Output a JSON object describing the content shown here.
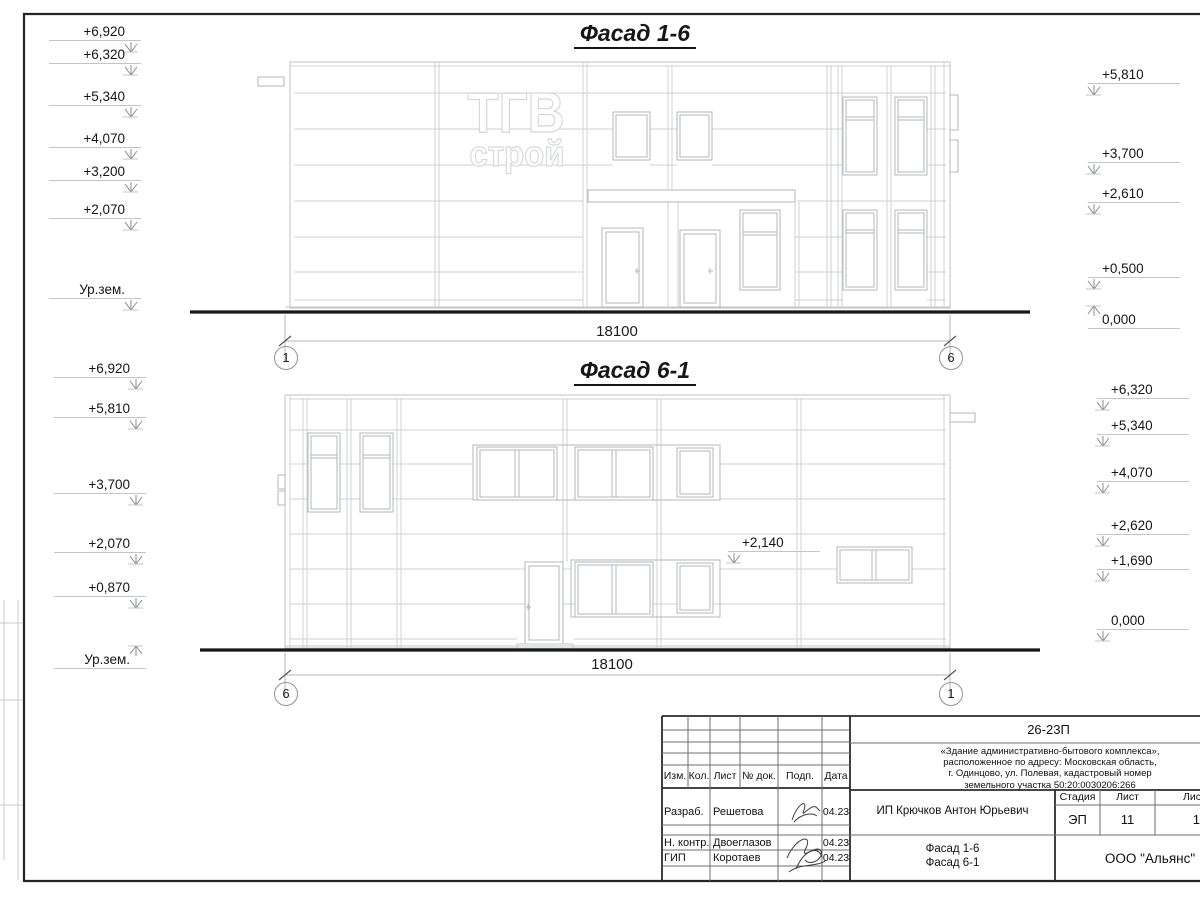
{
  "palette": {
    "line_light": "#d0d2d4",
    "line_mid": "#b5b8ba",
    "ground": "#181818",
    "frame": "#242424"
  },
  "logo": {
    "line1": "ТГВ",
    "line2": "строй"
  },
  "facade1": {
    "title": "Фасад 1-6",
    "dimension": "18100",
    "axis_left": "1",
    "axis_right": "6",
    "marks_left": [
      {
        "label": "+6,920",
        "x": 131,
        "y": 24,
        "dir": "down",
        "side": "left"
      },
      {
        "label": "+6,320",
        "x": 131,
        "y": 47,
        "dir": "down",
        "side": "left"
      },
      {
        "label": "+5,340",
        "x": 131,
        "y": 89,
        "dir": "down",
        "side": "left"
      },
      {
        "label": "+4,070",
        "x": 131,
        "y": 131,
        "dir": "down",
        "side": "left"
      },
      {
        "label": "+3,200",
        "x": 131,
        "y": 164,
        "dir": "down",
        "side": "left"
      },
      {
        "label": "+2,070",
        "x": 131,
        "y": 202,
        "dir": "down",
        "side": "left"
      },
      {
        "label": "Ур.зем.",
        "x": 131,
        "y": 282,
        "dir": "down",
        "side": "left"
      }
    ],
    "marks_right": [
      {
        "label": "+5,810",
        "x": 1094,
        "y": 67,
        "dir": "down",
        "side": "right"
      },
      {
        "label": "+3,700",
        "x": 1094,
        "y": 146,
        "dir": "down",
        "side": "right"
      },
      {
        "label": "+2,610",
        "x": 1094,
        "y": 186,
        "dir": "down",
        "side": "right"
      },
      {
        "label": "+0,500",
        "x": 1094,
        "y": 261,
        "dir": "down",
        "side": "right"
      },
      {
        "label": "0,000",
        "x": 1094,
        "y": 312,
        "dir": "up",
        "side": "right"
      }
    ]
  },
  "facade2": {
    "title": "Фасад 6-1",
    "dimension": "18100",
    "axis_left": "6",
    "axis_right": "1",
    "annotation": {
      "label": "+2,140",
      "x": 734,
      "y": 535,
      "dir": "down",
      "side": "right"
    },
    "marks_left": [
      {
        "label": "+6,920",
        "x": 136,
        "y": 361,
        "dir": "down",
        "side": "left"
      },
      {
        "label": "+5,810",
        "x": 136,
        "y": 401,
        "dir": "down",
        "side": "left"
      },
      {
        "label": "+3,700",
        "x": 136,
        "y": 477,
        "dir": "down",
        "side": "left"
      },
      {
        "label": "+2,070",
        "x": 136,
        "y": 536,
        "dir": "down",
        "side": "left"
      },
      {
        "label": "+0,870",
        "x": 136,
        "y": 580,
        "dir": "down",
        "side": "left"
      },
      {
        "label": "Ур.зем.",
        "x": 136,
        "y": 652,
        "dir": "up",
        "side": "left"
      }
    ],
    "marks_right": [
      {
        "label": "+6,320",
        "x": 1103,
        "y": 382,
        "dir": "down",
        "side": "right"
      },
      {
        "label": "+5,340",
        "x": 1103,
        "y": 418,
        "dir": "down",
        "side": "right"
      },
      {
        "label": "+4,070",
        "x": 1103,
        "y": 465,
        "dir": "down",
        "side": "right"
      },
      {
        "label": "+2,620",
        "x": 1103,
        "y": 518,
        "dir": "down",
        "side": "right"
      },
      {
        "label": "+1,690",
        "x": 1103,
        "y": 553,
        "dir": "down",
        "side": "right"
      },
      {
        "label": "0,000",
        "x": 1103,
        "y": 613,
        "dir": "down",
        "side": "right"
      }
    ]
  },
  "titleblock": {
    "doc_number": "26-23П",
    "desc_line1": "«Здание административно-бытового комплекса»,",
    "desc_line2": "расположенное по адресу: Московская область,",
    "desc_line3": "г. Одинцово, ул. Полевая, кадастровый номер",
    "desc_line4": "земельного участка 50:20:0030206:266",
    "client": "ИП Крючков Антон Юрьевич",
    "headers": {
      "izm": "Изм.",
      "kol": "Кол.",
      "list": "Лист",
      "doc": "№ док.",
      "podp": "Подп.",
      "data": "Дата",
      "stage": "Стадия",
      "sheet": "Лист",
      "sheets": "Листов"
    },
    "stage_value": "ЭП",
    "sheet_value": "11",
    "sheets_value": "17",
    "rows": [
      {
        "role": "Разраб.",
        "name": "Решетова",
        "date": "04.23"
      },
      {
        "role": "Н. контр.",
        "name": "Двоеглазов",
        "date": "04.23"
      },
      {
        "role": "ГИП",
        "name": "Коротаев",
        "date": "04.23"
      }
    ],
    "drawing_title_line1": "Фасад 1-6",
    "drawing_title_line2": "Фасад 6-1",
    "company": "ООО \"Альянс\""
  }
}
